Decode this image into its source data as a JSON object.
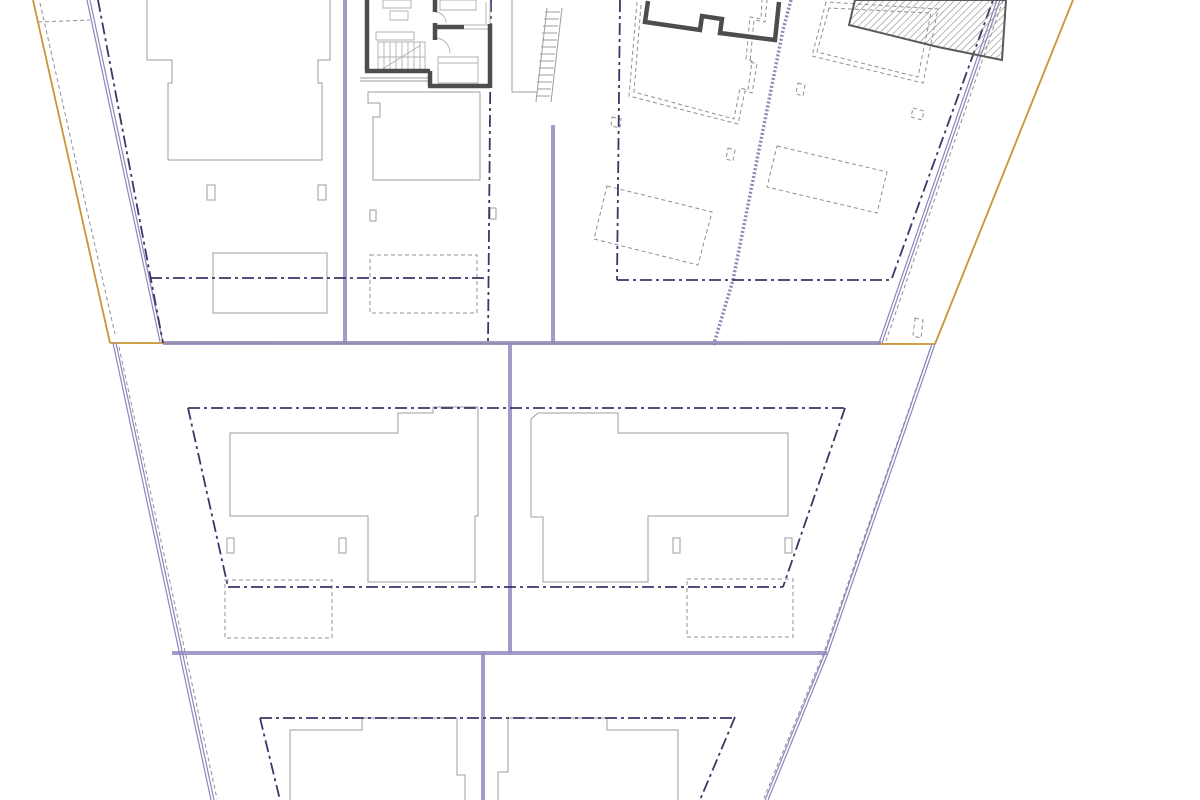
{
  "drawing": {
    "type": "architectural-site-plan",
    "canvas": {
      "width": 1200,
      "height": 800,
      "background": "#ffffff"
    },
    "colors": {
      "site_boundary": "#c99538",
      "road_edge": "#918ac0",
      "parcel_line": "#8d86bb",
      "setback_line": "#3a3768",
      "building_outline": "#9c9c9c",
      "hidden_edge": "#909090",
      "wall": "#4d4d4d",
      "furniture": "#b0b0b0"
    },
    "styles": {
      "light": {
        "stroke": "#9c9c9c",
        "width": 1
      },
      "dashed": {
        "stroke": "#909090",
        "width": 1,
        "dash": "4 3"
      },
      "orange": {
        "stroke": "#c99538",
        "width": 1.8
      },
      "road": {
        "stroke": "#918ac0",
        "width": 4,
        "opacity": 0.85
      },
      "double": {
        "stroke": "#8d86bb",
        "width": 1.2
      },
      "wavy": {
        "stroke": "#9088bd",
        "width": 3.5,
        "dash": "2 2"
      },
      "setback": {
        "stroke": "#3a3768",
        "width": 1.8,
        "dash": "12 4 3 4"
      },
      "furn": {
        "stroke": "#b0b0b0",
        "width": 0.9
      },
      "wall": {
        "stroke": "#4d4d4d",
        "width": 4.5
      },
      "hatchwall": {
        "stroke": "#5a5a5a",
        "width": 2,
        "fill": "hatch"
      }
    },
    "layers": [
      {
        "name": "building-footprints-light",
        "style": "light",
        "paths": [
          "M 147,0 L 147,60 L 172,60 L 172,83 L 168,83 L 168,160 L 322,160 L 322,83 L 318,83 L 318,60 L 330,60 L 330,0",
          "M 207,185 L 215,185 L 215,200 L 207,200 Z",
          "M 318,185 L 326,185 L 326,200 L 318,200 Z",
          "M 213,253 L 327,253 L 327,313 L 213,313 Z",
          "M 360,78 L 428,78",
          "M 360,81 L 428,81",
          "M 368,92 L 480,92 L 480,180 L 373,180 L 373,117 L 380,117 L 380,103 L 368,103 Z",
          "M 512,0 L 512,92 L 537,92",
          "M 370,210 L 376,210 L 376,221 L 370,221 Z",
          "M 490,208 L 496,208 L 496,219 L 490,219 Z",
          "M 230,433 L 398,433 L 398,413 L 433,413 L 433,407 L 478,407 L 478,516 L 475,516 L 475,582 L 368,582 L 368,516 L 230,516 Z",
          "M 227,538 L 234,538 L 234,553 L 227,553 Z",
          "M 339,538 L 346,538 L 346,553 L 339,553 Z",
          "M 531,419 L 538,413 L 618,413 L 618,433 L 788,433 L 788,516 L 648,516 L 648,582 L 543,582 L 543,517 L 531,517 Z",
          "M 673,538 L 680,538 L 680,553 L 673,553 Z",
          "M 785,538 L 792,538 L 792,553 L 785,553 Z",
          "M 290,800 L 290,730 L 362,730 L 362,718 L 457,718 L 457,775 L 465,775 L 465,800",
          "M 498,800 L 498,772 L 508,772 L 508,718 L 607,718 L 607,730 L 678,730 L 678,800"
        ]
      },
      {
        "name": "exterior-stair",
        "style": "light",
        "paths": [
          "M 547,8 L 536,102",
          "M 562,8 L 551,102",
          "M 545,12 L 560,12",
          "M 544,19 L 559,19",
          "M 543,26 L 558,26",
          "M 542,33 L 557,33",
          "M 542,40 L 557,40",
          "M 541,47 L 556,47",
          "M 540,54 L 555,54",
          "M 539,61 L 554,61",
          "M 539,68 L 554,68",
          "M 538,75 L 553,75",
          "M 537,82 L 552,82",
          "M 537,89 L 551,89",
          "M 536,96 L 550,96"
        ]
      },
      {
        "name": "hidden-edges-dashed",
        "style": "dashed",
        "paths": [
          "M 370,255 L 477,255 L 477,313 L 370,313 Z",
          "M 225,580 L 332,580 L 332,638 L 225,638 Z",
          "M 687,579 L 793,579 L 793,637 L 687,637 Z",
          "M 637,2 L 629,96 L 738,124 L 745,91 L 752,93 L 757,64 L 750,62 L 754,20 L 765,22 L 767,0",
          "M 641,5 L 634,92 L 734,119 L 740,88 L 748,90 L 752,61 L 746,59 L 750,17 L 761,19 L 762,0",
          "M 826,2 L 812,56 L 923,83 L 938,9 Z",
          "M 829,8 L 817,52 L 918,77 L 931,13 Z",
          "M 607,186 L 712,212 L 698,265 L 594,239 Z",
          "M 777,146 L 887,172 L 877,213 L 767,187 Z",
          "M 728,148 L 735,150 L 733,161 L 726,159 Z",
          "M 798,83 L 805,85 L 803,96 L 796,94 Z",
          "M 913,108 L 924,111 L 922,120 L 911,117 Z",
          "M 915,318 L 923,320 L 921,338 L 913,336 Z",
          "M 612,117 L 621,119 L 620,128 L 611,126 Z",
          "M 40,3 L 115,334",
          "M 38,22 L 90,20",
          "M 1003,0 L 886,341",
          "M 930,349 L 824,652 L 764,798",
          "M 119,347 L 217,799"
        ]
      },
      {
        "name": "site-boundary-orange",
        "style": "orange",
        "paths": [
          "M 33,0 L 110,343",
          "M 110,343 L 935,344",
          "M 935,344 L 1073,0"
        ]
      },
      {
        "name": "road-edges-thick",
        "style": "road",
        "paths": [
          "M 163,343 L 881,343",
          "M 172,653 L 827,653",
          "M 345,0 L 345,343",
          "M 553,125 L 553,343",
          "M 510,343 L 510,653",
          "M 483,653 L 483,800"
        ]
      },
      {
        "name": "parcel-boundary-double",
        "style": "double",
        "paths": [
          "M 87,0 L 160,342",
          "M 90,0 L 163,343",
          "M 113,343 L 211,800",
          "M 116,343 L 214,800",
          "M 997,0 L 879,343",
          "M 1000,0 L 882,343",
          "M 932,344 L 825,653 L 765,800",
          "M 935,344 L 828,653 L 768,800"
        ]
      },
      {
        "name": "retaining-wall-wavy",
        "style": "wavy",
        "paths": [
          "M 791,0 L 783,30 L 733,280 L 713,347"
        ]
      },
      {
        "name": "setback-lines-dashdot",
        "style": "setback",
        "paths": [
          "M 98,0 L 163,343",
          "M 150,278 L 488,278",
          "M 491,0 L 488,343",
          "M 620,0 L 617,280",
          "M 617,280 L 892,280",
          "M 892,278 L 993,0",
          "M 188,408 L 845,408",
          "M 188,408 L 228,587",
          "M 228,587 L 783,587",
          "M 845,408 L 783,587",
          "M 260,718 L 735,718",
          "M 260,718 L 280,800",
          "M 735,717 L 700,800"
        ]
      },
      {
        "name": "floorplan-furniture-details",
        "style": "furn",
        "paths": [
          "M 383,0 L 411,0 L 411,8 L 383,8 Z",
          "M 390,11 L 408,11 L 408,20 L 390,20 Z",
          "M 376,32 L 414,32 L 414,40 L 376,40 Z",
          "M 440,0 L 476,0 L 476,10 L 440,10 Z",
          "M 438,57 L 478,57 L 478,83 L 438,83 Z",
          "M 438,63 L 478,63",
          "M 378,42 L 425,42 L 425,72 L 378,72 Z",
          "M 378,57 L 425,57",
          "M 384,42 L 384,72",
          "M 390,42 L 390,72",
          "M 396,42 L 396,72",
          "M 402,42 L 402,72",
          "M 408,42 L 408,72",
          "M 414,42 L 414,72",
          "M 420,42 L 420,72",
          "M 381,70 L 421,45",
          "M 464,25 L 488,25",
          "M 464,29 L 488,29",
          "M 486,2 L 486,24",
          "M 490,2 L 490,24",
          "M 435,12 A 11,11 0 0 1 446,23",
          "M 450,53 A 15,15 0 0 0 435,38"
        ]
      },
      {
        "name": "floorplan-walls-dark",
        "style": "wall",
        "paths": [
          "M 367,0 L 367,71",
          "M 365,71 L 430,71",
          "M 430,71 L 430,86",
          "M 428,86 L 490,86",
          "M 490,88 L 490,24",
          "M 433,27 L 464,27",
          "M 435,0 L 435,12",
          "M 435,23 L 435,40",
          "M 648,1 L 645,22 L 700,30 L 702,16 L 722,19 L 720,33 L 775,40 L 779,2"
        ]
      },
      {
        "name": "existing-building-hatched",
        "style": "hatchwall",
        "paths": [
          "M 855,0 L 849,25 L 938,47 L 1002,60 L 1006,0 Z"
        ]
      }
    ]
  }
}
